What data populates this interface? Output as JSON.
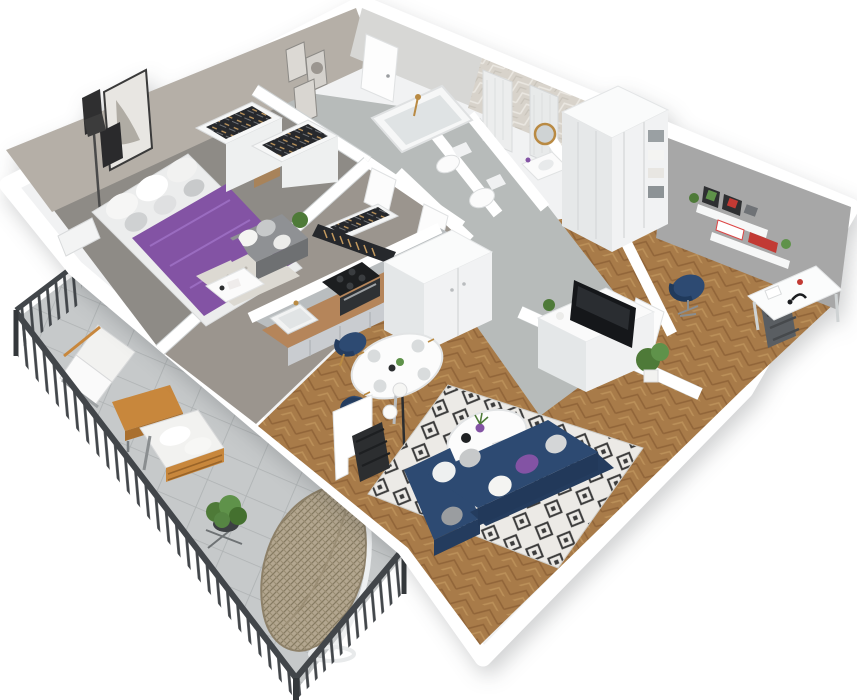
{
  "scene": {
    "title": "3D isometric cutaway floor plan of a furnished apartment with balcony",
    "type": "architectural-3d-floor-plan-render",
    "view": "perspective from above, walls cut",
    "background": "#ffffff"
  },
  "palette": {
    "wall_white": "#ffffff",
    "wall_shade": "#e9ebec",
    "inner_gray_wall": "#a7a7a7",
    "bedroom_wall_taupe": "#b5afa7",
    "wood_floor": "#a87b49",
    "wood_floor_dark": "#916539",
    "hall_tile": "#b7bbba",
    "balcony_tile": "#c6c9ca",
    "bath_tile": "#d8d3cb",
    "navy": "#2d4a72",
    "navy_dark": "#243c5e",
    "purple": "#8353a4",
    "rug_base": "#eceae6",
    "rug_dark": "#3c3c3c",
    "counter_wood": "#b5855a",
    "cabinet_gray": "#c9ccd0",
    "balcony_wood": "#c8873c",
    "railing": "#42464a",
    "plant_green": "#4e7a38",
    "brass": "#b98a43",
    "black": "#1b1d20",
    "concrete": "#b9bdbf",
    "clothes_dark": "#26282c"
  },
  "rooms": [
    {
      "id": "bedroom",
      "name": "Bedroom",
      "floor": "gray",
      "items": [
        "double bed with purple bedspread",
        "white and gray pillows",
        "wooden nightstand",
        "open wardrobes with hanging clothes",
        "black floor lamp",
        "gallery-wall picture frames",
        "white radiator"
      ]
    },
    {
      "id": "small-room",
      "name": "Small room / study",
      "floor": "gray with light rug",
      "items": [
        "gray daybed with cushions",
        "white desk table",
        "speckled rug",
        "purple throw",
        "potted plant",
        "open wardrobe with hanging clothes"
      ]
    },
    {
      "id": "bathroom",
      "name": "Bathroom",
      "floor": "gray tile",
      "items": [
        "bathtub with brass shower set",
        "toilet",
        "herringbone tiled walls",
        "walk-in shower with white tiled columns"
      ]
    },
    {
      "id": "wc",
      "name": "WC",
      "items": [
        "toilet",
        "vanity washbasin",
        "round brass-framed mirror",
        "purple bottle"
      ]
    },
    {
      "id": "hallway",
      "name": "Hallway / entry",
      "floor": "gray tile",
      "items": [
        "white entrance door",
        "large white wardrobe with open shelves and baskets",
        "white interior doors"
      ]
    },
    {
      "id": "kitchen",
      "name": "Kitchen",
      "floor": "herringbone wood",
      "items": [
        "gray base cabinets with wooden countertop",
        "white sink with brass faucet",
        "black cooktop",
        "dark oven",
        "tall white cabinet unit",
        "magnetic knife strip on wall",
        "concrete backsplash half-wall"
      ]
    },
    {
      "id": "dining",
      "name": "Dining area",
      "floor": "herringbone wood",
      "items": [
        "round white table set for four with gold cutlery",
        "three navy chairs with brass legs",
        "black floor lamp with three white globes"
      ]
    },
    {
      "id": "living-room",
      "name": "Living room",
      "floor": "herringbone wood",
      "items": [
        "navy corner sofa",
        "white, gray and purple cushions",
        "black and white diamond-pattern rug",
        "round white coffee table with purple vase, plant, black kettle and book",
        "white TV sideboard with flat TV",
        "half wall",
        "potted plant",
        "black radiator on stepped wall"
      ]
    },
    {
      "id": "office",
      "name": "Home office nook",
      "items": [
        "white desk with black lamp and papers",
        "navy swivel chair",
        "two white wall shelves with framed pictures, plants and red books",
        "gray feature wall",
        "dark radiator below window"
      ]
    },
    {
      "id": "balcony",
      "name": "Balcony / terrace",
      "floor": "large concrete tiles",
      "items": [
        "dark metal railing",
        "outdoor armchair with white cushions",
        "orange wooden coffee table",
        "outdoor bench with white cushions and wood slats",
        "rattan hanging egg chair on white stand",
        "potted plant on metal stand"
      ]
    }
  ]
}
